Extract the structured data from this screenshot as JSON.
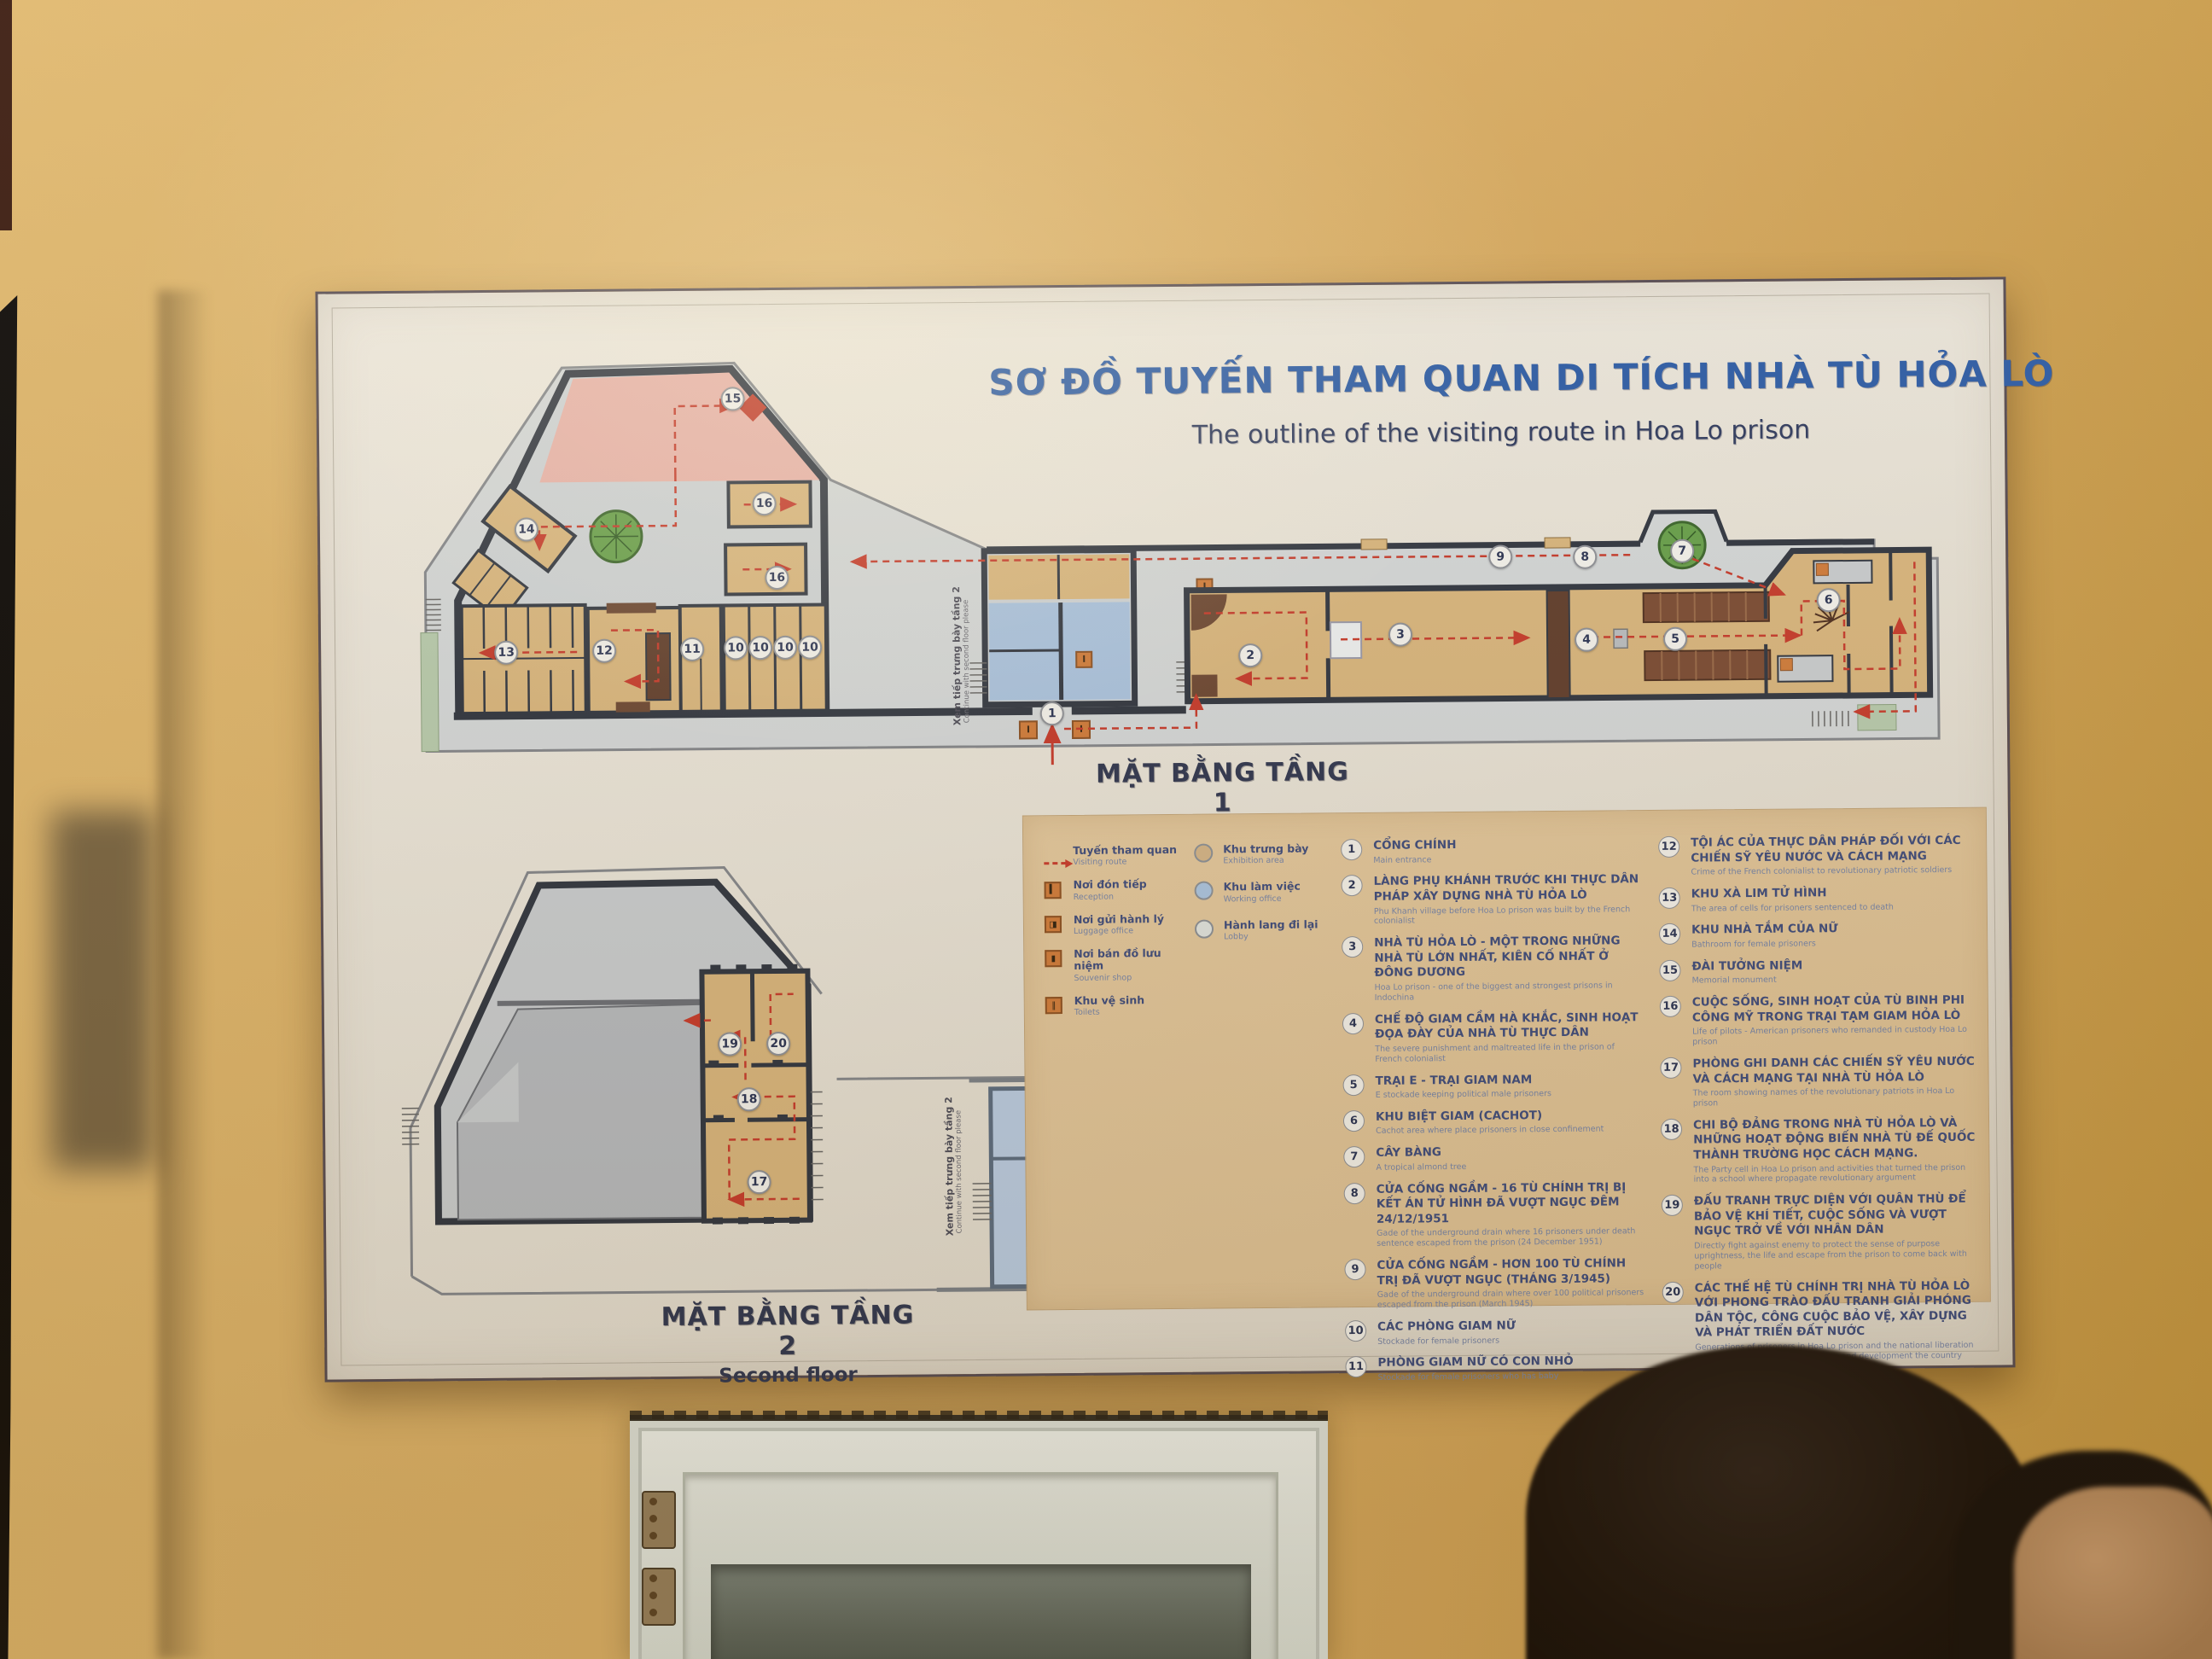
{
  "sign": {
    "title_vi": "SƠ ĐỒ TUYẾN THAM QUAN DI TÍCH NHÀ TÙ HỎA LÒ",
    "title_en": "The outline of the visiting route in Hoa Lo prison",
    "floor1_label_vi": "MẶT BẰNG TẦNG 1",
    "floor1_label_en": "First floor",
    "floor2_label_vi": "MẶT BẰNG TẦNG 2",
    "floor2_label_en": "Second floor",
    "continue_note_vi": "Xem tiếp trưng bày tầng 2",
    "continue_note_en": "Continue with second floor please",
    "accent_colors": {
      "route_red": "#c6392b",
      "exhibition_tan": "#d2b488",
      "working_blue": "#a9c4e1",
      "lobby_grey": "#dfe3e0",
      "title_blue": "#2b5ba6"
    },
    "legend_symbols": [
      {
        "icon": "route-arrow-icon",
        "vi": "Tuyến tham quan",
        "en": "Visiting route"
      },
      {
        "icon": "reception-icon",
        "vi": "Nơi đón tiếp",
        "en": "Reception"
      },
      {
        "icon": "luggage-icon",
        "vi": "Nơi gửi hành lý",
        "en": "Luggage office"
      },
      {
        "icon": "souvenir-icon",
        "vi": "Nơi bán đồ lưu niệm",
        "en": "Souvenir shop"
      },
      {
        "icon": "toilets-icon",
        "vi": "Khu vệ sinh",
        "en": "Toilets"
      }
    ],
    "legend_areas": [
      {
        "color": "#d2b488",
        "vi": "Khu trưng bày",
        "en": "Exhibition area"
      },
      {
        "color": "#a9c4e1",
        "vi": "Khu làm việc",
        "en": "Working office"
      },
      {
        "color": "#dfe3e0",
        "vi": "Hành lang đi lại",
        "en": "Lobby"
      }
    ],
    "legend_items": [
      {
        "n": "1",
        "vi": "CỔNG CHÍNH",
        "en": "Main entrance"
      },
      {
        "n": "2",
        "vi": "LÀNG PHỤ KHÁNH TRƯỚC KHI THỰC DÂN PHÁP XÂY DỰNG NHÀ TÙ HỎA LÒ",
        "en": "Phu Khanh village before Hoa Lo prison was built by the French colonialist"
      },
      {
        "n": "3",
        "vi": "NHÀ TÙ HỎA LÒ - MỘT TRONG NHỮNG NHÀ TÙ LỚN NHẤT, KIÊN CỐ NHẤT Ở ĐÔNG DƯƠNG",
        "en": "Hoa Lo prison - one of the biggest and strongest prisons in Indochina"
      },
      {
        "n": "4",
        "vi": "CHẾ ĐỘ GIAM CẦM HÀ KHẮC, SINH HOẠT ĐỌA ĐÀY CỦA NHÀ TÙ THỰC DÂN",
        "en": "The severe punishment and maltreated life in the prison of French colonialist"
      },
      {
        "n": "5",
        "vi": "TRẠI E - TRẠI GIAM NAM",
        "en": "E stockade keeping political male prisoners"
      },
      {
        "n": "6",
        "vi": "KHU BIỆT GIAM (CACHOT)",
        "en": "Cachot area where place prisoners in close confinement"
      },
      {
        "n": "7",
        "vi": "CÂY BÀNG",
        "en": "A tropical almond tree"
      },
      {
        "n": "8",
        "vi": "CỬA CỐNG NGẦM - 16 TÙ CHÍNH TRỊ BỊ KẾT ÁN TỬ HÌNH ĐÃ VƯỢT NGỤC ĐÊM 24/12/1951",
        "en": "Gade of the underground drain where 16 prisoners under death sentence escaped from the prison (24 December 1951)"
      },
      {
        "n": "9",
        "vi": "CỬA CỐNG NGẦM - HƠN 100 TÙ CHÍNH TRỊ ĐÃ VƯỢT NGỤC (THÁNG 3/1945)",
        "en": "Gade of the underground drain where over 100 political prisoners escaped from the prison (March 1945)"
      },
      {
        "n": "10",
        "vi": "CÁC PHÒNG GIAM NỮ",
        "en": "Stockade for female prisoners"
      },
      {
        "n": "11",
        "vi": "PHÒNG GIAM NỮ CÓ CON NHỎ",
        "en": "Stockade for female prisoners who has baby"
      },
      {
        "n": "12",
        "vi": "TỘI ÁC CỦA THỰC DÂN PHÁP ĐỐI VỚI CÁC CHIẾN SỸ YÊU NƯỚC VÀ CÁCH MẠNG",
        "en": "Crime of the French colonialist to revolutionary patriotic soldiers"
      },
      {
        "n": "13",
        "vi": "KHU XÀ LIM TỬ HÌNH",
        "en": "The area of cells for prisoners sentenced to death"
      },
      {
        "n": "14",
        "vi": "KHU NHÀ TẮM CỦA NỮ",
        "en": "Bathroom for female prisoners"
      },
      {
        "n": "15",
        "vi": "ĐÀI TƯỞNG NIỆM",
        "en": "Memorial monument"
      },
      {
        "n": "16",
        "vi": "CUỘC SỐNG, SINH HOẠT CỦA TÙ BINH PHI CÔNG MỸ TRONG TRẠI TẠM GIAM HỎA LÒ",
        "en": "Life of pilots - American prisoners who remanded in custody Hoa Lo prison"
      },
      {
        "n": "17",
        "vi": "PHÒNG GHI DANH CÁC CHIẾN SỸ YÊU NƯỚC VÀ CÁCH MẠNG TẠI NHÀ TÙ HỎA LÒ",
        "en": "The room showing names of the revolutionary patriots in Hoa Lo prison"
      },
      {
        "n": "18",
        "vi": "CHI BỘ ĐẢNG TRONG NHÀ TÙ HỎA LÒ VÀ NHỮNG HOẠT ĐỘNG BIẾN NHÀ TÙ ĐẾ QUỐC THÀNH TRƯỜNG HỌC CÁCH MẠNG.",
        "en": "The Party cell in Hoa Lo prison and activities that turned the prison into a school where propagate revolutionary argument"
      },
      {
        "n": "19",
        "vi": "ĐẤU TRANH TRỰC DIỆN VỚI QUÂN THÙ ĐỂ BẢO VỆ KHÍ TIẾT, CUỘC SỐNG VÀ VƯỢT NGỤC TRỞ VỀ VỚI NHÂN DÂN",
        "en": "Directly fight against enemy to protect the sense of purpose uprightness, the life and escape from the prison to come back with people"
      },
      {
        "n": "20",
        "vi": "CÁC THẾ HỆ TÙ CHÍNH TRỊ NHÀ TÙ HỎA LÒ VỚI PHONG TRÀO ĐẤU TRANH GIẢI PHÓNG DÂN TỘC, CÔNG CUỘC BẢO VỆ, XÂY DỰNG VÀ PHÁT TRIỂN ĐẤT NƯỚC",
        "en": "Generations of prisoners in Hoa Lo prison and the national liberation movement, protection construction and development the country"
      }
    ],
    "floor1_markers": [
      "15",
      "16",
      "16",
      "14",
      "13",
      "12",
      "11",
      "10",
      "10",
      "10",
      "10",
      "1",
      "2",
      "3",
      "4",
      "5",
      "6",
      "7",
      "8",
      "9"
    ],
    "floor2_markers": [
      "19",
      "20",
      "18",
      "17"
    ]
  }
}
